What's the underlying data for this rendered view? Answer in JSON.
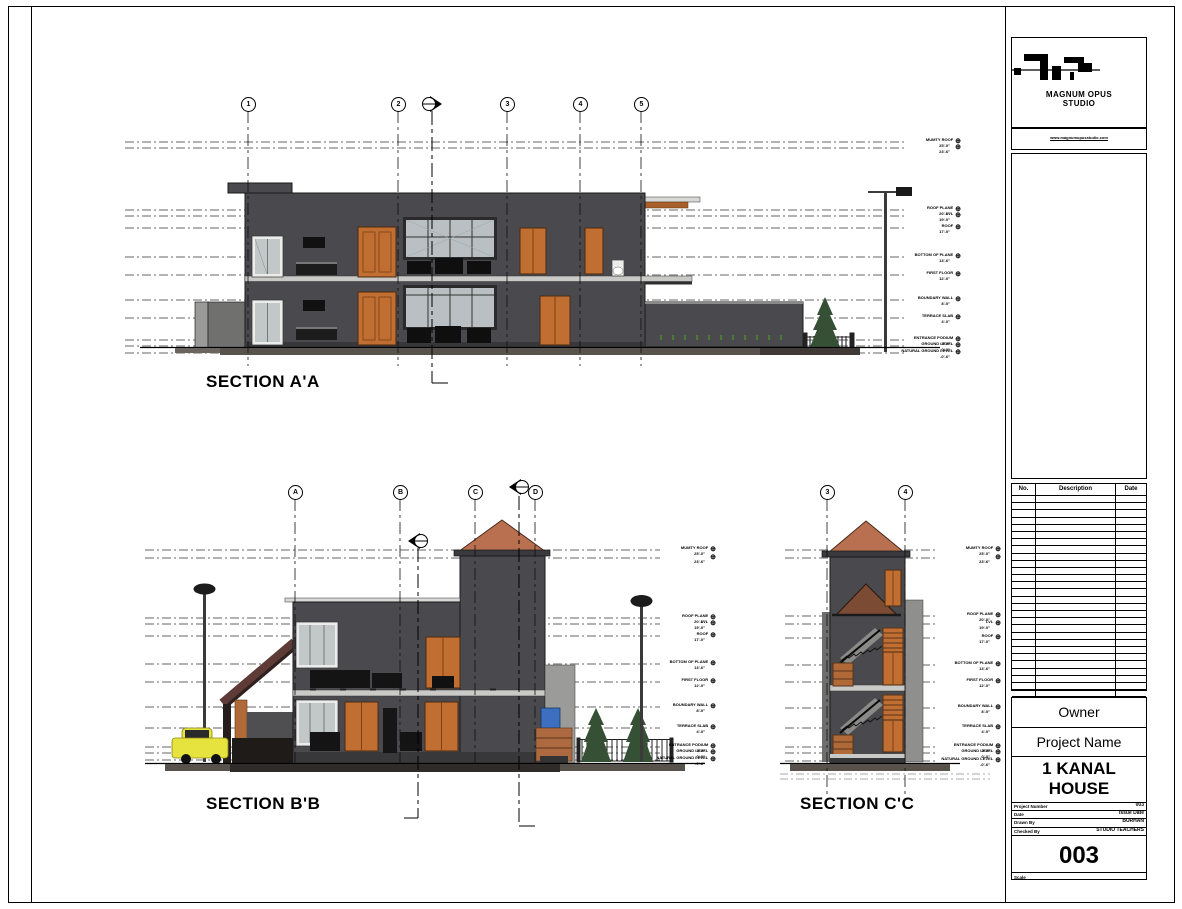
{
  "sections": {
    "a": {
      "title": "SECTION A'A",
      "bubbles": [
        "1",
        "2",
        "3",
        "4",
        "5"
      ]
    },
    "b": {
      "title": "SECTION B'B",
      "bubbles": [
        "A",
        "B",
        "C",
        "D"
      ]
    },
    "c": {
      "title": "SECTION C'C",
      "bubbles": [
        "3",
        "4"
      ]
    }
  },
  "levels": [
    {
      "name": "MUMTY ROOF",
      "elev": "25'-0\""
    },
    {
      "name": "",
      "elev": "23'-6\""
    },
    {
      "name": "ROOF PLANE",
      "elev": "20'-0\""
    },
    {
      "name": "LVL",
      "elev": "19'-0\""
    },
    {
      "name": "ROOF",
      "elev": "17'-0\""
    },
    {
      "name": "BOTTOM OF PLANE",
      "elev": "13'-6\""
    },
    {
      "name": "FIRST FLOOR",
      "elev": "12'-0\""
    },
    {
      "name": "BOUNDARY WALL",
      "elev": "8'-0\""
    },
    {
      "name": "TERRACE SLAB",
      "elev": "4'-0\""
    },
    {
      "name": "ENTRANCE PODIUM",
      "elev": "1'-0\""
    },
    {
      "name": "GROUND LEVEL",
      "elev": "0'-0\""
    },
    {
      "name": "NATURAL GROUND LEVEL",
      "elev": "-0'-6\""
    }
  ],
  "icons": {
    "level_target": "⊕"
  },
  "title_block": {
    "studio_name_line1": "MAGNUM OPUS",
    "studio_name_line2": "STUDIO",
    "website": "www.magnumopusstudio.com",
    "revision_table": {
      "headers": [
        "No.",
        "Description",
        "Date"
      ],
      "empty_rows": 28
    },
    "owner": "Owner",
    "project_name": "Project Name",
    "project_title_line1": "1 KANAL",
    "project_title_line2": "HOUSE",
    "fields": [
      {
        "label": "Project Number",
        "value": "003"
      },
      {
        "label": "Date",
        "value": "Issue Date"
      },
      {
        "label": "Drawn By",
        "value": "BURHAN"
      },
      {
        "label": "Checked By",
        "value": "STUDIO TEACHERS"
      }
    ],
    "sheet_number": "003",
    "scale_label": "Scale"
  },
  "colors": {
    "building_gray": "#4A4A4E",
    "plinth_gray": "#38383B",
    "slab_light": "#C9C9C7",
    "door_orange": "#C06E32",
    "fascia_brown": "#A85F2A",
    "pyramid_roof": "#B87050",
    "carport_maroon": "#5F3B38",
    "tree_green": "#355034",
    "car_yellow": "#E6E23E",
    "water_blue": "#3C6FC0",
    "ground_strip": "#57524C"
  }
}
